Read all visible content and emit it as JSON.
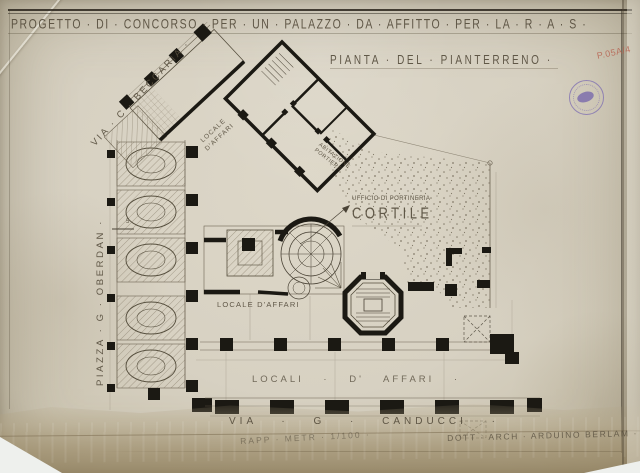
{
  "sheet": {
    "title": "PROGETTO · DI · CONCORSO · PER · UN · PALAZZO · DA · AFFITTO · PER · LA · R · A · S ·",
    "subtitle": "PIANTA · DEL · PIANTERRENO ·",
    "archive_mark": "P.05A/4",
    "scale_note": "RAPP · METR · 1/100 ·",
    "signature": "DOTT · ARCH · ARDUINO BERLAM ·"
  },
  "streets": {
    "beccaria": "VIA · C · BECCARIA ·",
    "oberdan": "PIAZZA · G · OBERDAN ·",
    "canducci": "VIA · G · CANDUCCI ·"
  },
  "rooms": {
    "cortile": "CORTILE",
    "portineria": "UFFICIO DI PORTINERIA",
    "wing_shop_line1": "LOCALE",
    "wing_shop_line2": "D'AFFARI",
    "shop_single": "LOCALE D'AFFARI",
    "shops_row": "LOCALI · D' AFFARI ·",
    "porter_line1": "ABITAZIONE",
    "porter_line2": "PORTIERE",
    "dimension_mark": "5"
  },
  "colors": {
    "paper": "#d8d2c3",
    "ink": "#1b1913",
    "faded_ink": "#5d5546",
    "stamp_purple": "#7c6cb2",
    "red_pencil": "#b4604e"
  }
}
